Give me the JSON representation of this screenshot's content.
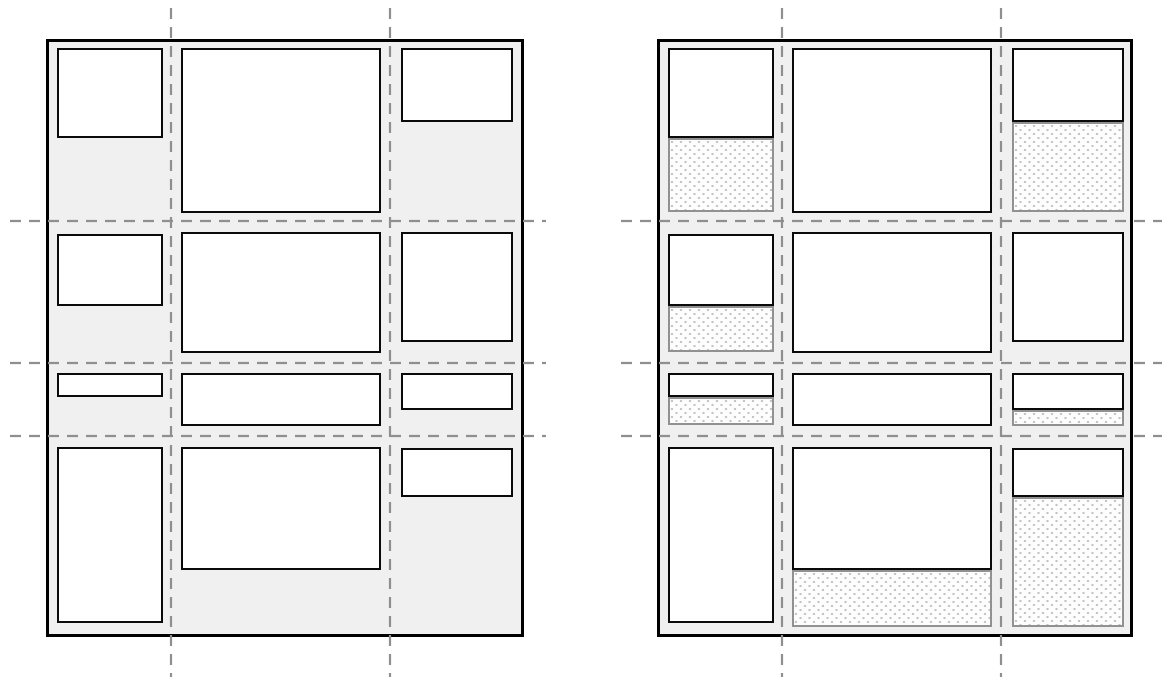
{
  "colors": {
    "page_bg": "#ffffff",
    "container_bg": "#f0f0f0",
    "container_border": "#000000",
    "item_fill": "#ffffff",
    "item_border": "#0a0a0a",
    "grid_line": "#8f8f8f",
    "remainder_border": "#919191",
    "remainder_bg": "#fdfdfd",
    "remainder_dot": "#c2c2c2"
  },
  "grid_line_style": {
    "stroke_width": 2.2,
    "dash_pattern": "11 8"
  },
  "figures": [
    {
      "name": "grid-figure-plain",
      "container": {
        "x": 46,
        "y": 39,
        "w": 478,
        "h": 598
      },
      "grid_lines": {
        "vertical_x": [
          171,
          390
        ],
        "vertical_y1": 8,
        "vertical_y2": 677,
        "horizontal_y": [
          221,
          363,
          436
        ],
        "horizontal_x1": 10,
        "horizontal_x2": 546
      },
      "items": [
        {
          "id": "r1c1",
          "x": 57,
          "y": 48,
          "w": 106,
          "h": 90
        },
        {
          "id": "r1c2",
          "x": 181,
          "y": 48,
          "w": 200,
          "h": 165
        },
        {
          "id": "r1c3",
          "x": 401,
          "y": 48,
          "w": 112,
          "h": 74
        },
        {
          "id": "r2c1",
          "x": 57,
          "y": 234,
          "w": 106,
          "h": 72
        },
        {
          "id": "r2c2",
          "x": 181,
          "y": 232,
          "w": 200,
          "h": 121
        },
        {
          "id": "r2c3",
          "x": 401,
          "y": 232,
          "w": 112,
          "h": 110
        },
        {
          "id": "r3c1",
          "x": 57,
          "y": 373,
          "w": 106,
          "h": 24
        },
        {
          "id": "r3c2",
          "x": 181,
          "y": 373,
          "w": 200,
          "h": 53
        },
        {
          "id": "r3c3",
          "x": 401,
          "y": 373,
          "w": 112,
          "h": 37
        },
        {
          "id": "r4c1",
          "x": 57,
          "y": 447,
          "w": 106,
          "h": 176
        },
        {
          "id": "r4c2",
          "x": 181,
          "y": 447,
          "w": 200,
          "h": 123
        },
        {
          "id": "r4c3",
          "x": 401,
          "y": 448,
          "w": 112,
          "h": 49
        }
      ],
      "cell_remainders": []
    },
    {
      "name": "grid-figure-dotted-cells",
      "container": {
        "x": 657,
        "y": 39,
        "w": 476,
        "h": 598
      },
      "grid_lines": {
        "vertical_x": [
          782,
          1001
        ],
        "vertical_y1": 8,
        "vertical_y2": 677,
        "horizontal_y": [
          221,
          363,
          436
        ],
        "horizontal_x1": 621,
        "horizontal_x2": 1162
      },
      "items": [
        {
          "id": "r1c1",
          "x": 668,
          "y": 48,
          "w": 106,
          "h": 90
        },
        {
          "id": "r1c2",
          "x": 792,
          "y": 48,
          "w": 200,
          "h": 165
        },
        {
          "id": "r1c3",
          "x": 1012,
          "y": 48,
          "w": 112,
          "h": 74
        },
        {
          "id": "r2c1",
          "x": 668,
          "y": 234,
          "w": 106,
          "h": 72
        },
        {
          "id": "r2c2",
          "x": 792,
          "y": 232,
          "w": 200,
          "h": 121
        },
        {
          "id": "r2c3",
          "x": 1012,
          "y": 232,
          "w": 112,
          "h": 110
        },
        {
          "id": "r3c1",
          "x": 668,
          "y": 373,
          "w": 106,
          "h": 24
        },
        {
          "id": "r3c2",
          "x": 792,
          "y": 373,
          "w": 200,
          "h": 53
        },
        {
          "id": "r3c3",
          "x": 1012,
          "y": 373,
          "w": 112,
          "h": 37
        },
        {
          "id": "r4c1",
          "x": 668,
          "y": 447,
          "w": 106,
          "h": 176
        },
        {
          "id": "r4c2",
          "x": 792,
          "y": 447,
          "w": 200,
          "h": 123
        },
        {
          "id": "r4c3",
          "x": 1012,
          "y": 448,
          "w": 112,
          "h": 49
        }
      ],
      "cell_remainders": [
        {
          "id": "r1c1",
          "x": 668,
          "y": 138,
          "w": 106,
          "h": 74
        },
        {
          "id": "r1c3",
          "x": 1012,
          "y": 122,
          "w": 112,
          "h": 90
        },
        {
          "id": "r2c1",
          "x": 668,
          "y": 306,
          "w": 106,
          "h": 46
        },
        {
          "id": "r3c1",
          "x": 668,
          "y": 397,
          "w": 106,
          "h": 28
        },
        {
          "id": "r3c3",
          "x": 1012,
          "y": 410,
          "w": 112,
          "h": 16
        },
        {
          "id": "r4c2",
          "x": 792,
          "y": 570,
          "w": 200,
          "h": 57
        },
        {
          "id": "r4c3",
          "x": 1012,
          "y": 497,
          "w": 112,
          "h": 130
        }
      ]
    }
  ]
}
